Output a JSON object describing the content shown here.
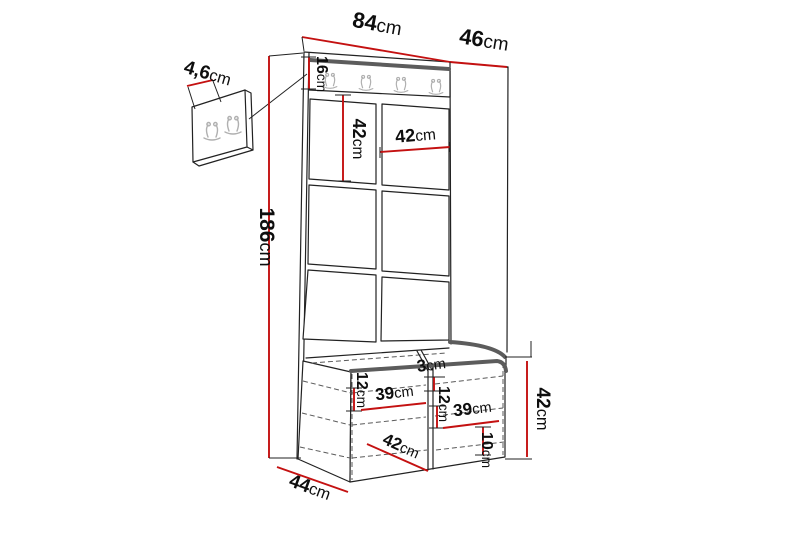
{
  "diagram": {
    "labels": {
      "top_width": "84cm",
      "top_depth": "46cm",
      "rail_height": "16cm",
      "detail_thickness": "4,6cm",
      "total_height": "186cm",
      "panel_height": "42cm",
      "panel_width": "42cm",
      "seat_thickness": "3cm",
      "left_compartment_height": "12cm",
      "left_compartment_width": "39cm",
      "right_compartment_height": "12cm",
      "right_compartment_width": "39cm",
      "bottom_clearance": "10cm",
      "bench_inner_width": "42cm",
      "bench_depth": "44cm",
      "bench_height": "42cm"
    },
    "counts": {
      "rail_hooks": 4,
      "detail_panel_hooks": 2,
      "visible_upholstered_panels": 6
    },
    "colors": {
      "background": "#ffffff",
      "dimension_line": "#c41111",
      "outline": "#222222",
      "rail_accent": "#5c5c5c",
      "hook": "#b0b0b0",
      "text": "#0e0e0e"
    },
    "icons": {
      "coat_hook": "double-prong-coat-hook"
    }
  }
}
